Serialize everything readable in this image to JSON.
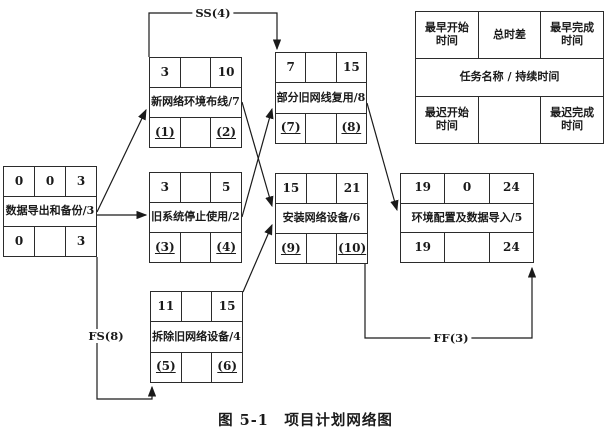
{
  "caption": "图 5-1　项目计划网络图",
  "legend": {
    "top": [
      "最早开始时间",
      "总时差",
      "最早完成时间"
    ],
    "middle": "任务名称 / 持续时间",
    "bottom": [
      "最迟开始时间",
      "",
      "最迟完成时间"
    ]
  },
  "tasks": [
    {
      "id": "backup",
      "name": "数据导出和备份/3",
      "top": [
        "0",
        "0",
        "3"
      ],
      "bottom": [
        "0",
        "",
        "3"
      ]
    },
    {
      "id": "cabling",
      "name": "新网络环境布线/7",
      "top": [
        "3",
        "",
        "10"
      ],
      "bottom": [
        "(1)",
        "",
        "(2)"
      ]
    },
    {
      "id": "stop-old",
      "name": "旧系统停止使用/2",
      "top": [
        "3",
        "",
        "5"
      ],
      "bottom": [
        "(3)",
        "",
        "(4)"
      ]
    },
    {
      "id": "remove",
      "name": "拆除旧网络设备/4",
      "top": [
        "11",
        "",
        "15"
      ],
      "bottom": [
        "(5)",
        "",
        "(6)"
      ]
    },
    {
      "id": "reuse",
      "name": "部分旧网线复用/8",
      "top": [
        "7",
        "",
        "15"
      ],
      "bottom": [
        "(7)",
        "",
        "(8)"
      ]
    },
    {
      "id": "install",
      "name": "安装网络设备/6",
      "top": [
        "15",
        "",
        "21"
      ],
      "bottom": [
        "(9)",
        "",
        "(10)"
      ]
    },
    {
      "id": "config",
      "name": "环境配置及数据导入/5",
      "top": [
        "19",
        "0",
        "24"
      ],
      "bottom": [
        "19",
        "",
        "24"
      ]
    }
  ],
  "edges": [
    {
      "from": "backup",
      "to": "cabling",
      "label": ""
    },
    {
      "from": "backup",
      "to": "stop-old",
      "label": ""
    },
    {
      "from": "backup",
      "to": "remove",
      "label": "FS(8)"
    },
    {
      "from": "cabling",
      "to": "reuse",
      "label": "SS(4)"
    },
    {
      "from": "cabling",
      "to": "install",
      "label": ""
    },
    {
      "from": "stop-old",
      "to": "reuse",
      "label": ""
    },
    {
      "from": "remove",
      "to": "install",
      "label": ""
    },
    {
      "from": "reuse",
      "to": "config",
      "label": ""
    },
    {
      "from": "install",
      "to": "config",
      "label": "FF(3)"
    }
  ],
  "colors": {
    "line": "#1a1a1a",
    "background": "#ffffff"
  }
}
